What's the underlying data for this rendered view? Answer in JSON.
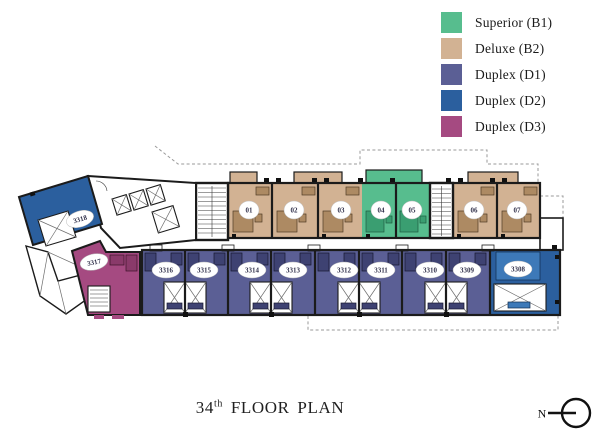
{
  "legend": {
    "items": [
      {
        "label": "Superior (B1)",
        "color": "#57bd8e"
      },
      {
        "label": "Deluxe (B2)",
        "color": "#d2b293"
      },
      {
        "label": "Duplex (D1)",
        "color": "#5b5f95"
      },
      {
        "label": "Duplex (D2)",
        "color": "#2b5f9e"
      },
      {
        "label": "Duplex (D3)",
        "color": "#a54a81"
      }
    ]
  },
  "title": {
    "number": "34",
    "suffix": "th",
    "label": "FLOOR PLAN"
  },
  "compass": {
    "label": "N"
  },
  "plan": {
    "top_row": [
      {
        "label": "01",
        "type": "Deluxe (B2)"
      },
      {
        "label": "02",
        "type": "Deluxe (B2)"
      },
      {
        "label": "03",
        "type": "Deluxe (B2)"
      },
      {
        "label": "04",
        "type": "Superior (B1)"
      },
      {
        "label": "05",
        "type": "Superior (B1)"
      },
      {
        "label": "06",
        "type": "Deluxe (B2)"
      },
      {
        "label": "07",
        "type": "Deluxe (B2)"
      }
    ],
    "bottom_row": [
      {
        "label": "3316",
        "type": "Duplex (D1)"
      },
      {
        "label": "3315",
        "type": "Duplex (D1)"
      },
      {
        "label": "3314",
        "type": "Duplex (D1)"
      },
      {
        "label": "3313",
        "type": "Duplex (D1)"
      },
      {
        "label": "3312",
        "type": "Duplex (D1)"
      },
      {
        "label": "3311",
        "type": "Duplex (D1)"
      },
      {
        "label": "3310",
        "type": "Duplex (D1)"
      },
      {
        "label": "3309",
        "type": "Duplex (D1)"
      },
      {
        "label": "3308",
        "type": "Duplex (D2)"
      }
    ],
    "left_block": [
      {
        "label": "3318",
        "type": "Duplex (D2)"
      },
      {
        "label": "3317",
        "type": "Duplex (D3)"
      }
    ]
  },
  "colors": {
    "superior": "#57bd8e",
    "deluxe": "#d2b293",
    "duplex_d1": "#5b5f95",
    "duplex_d2": "#2b5f9e",
    "duplex_d3": "#a54a81",
    "walls": "#1b1b1b"
  }
}
